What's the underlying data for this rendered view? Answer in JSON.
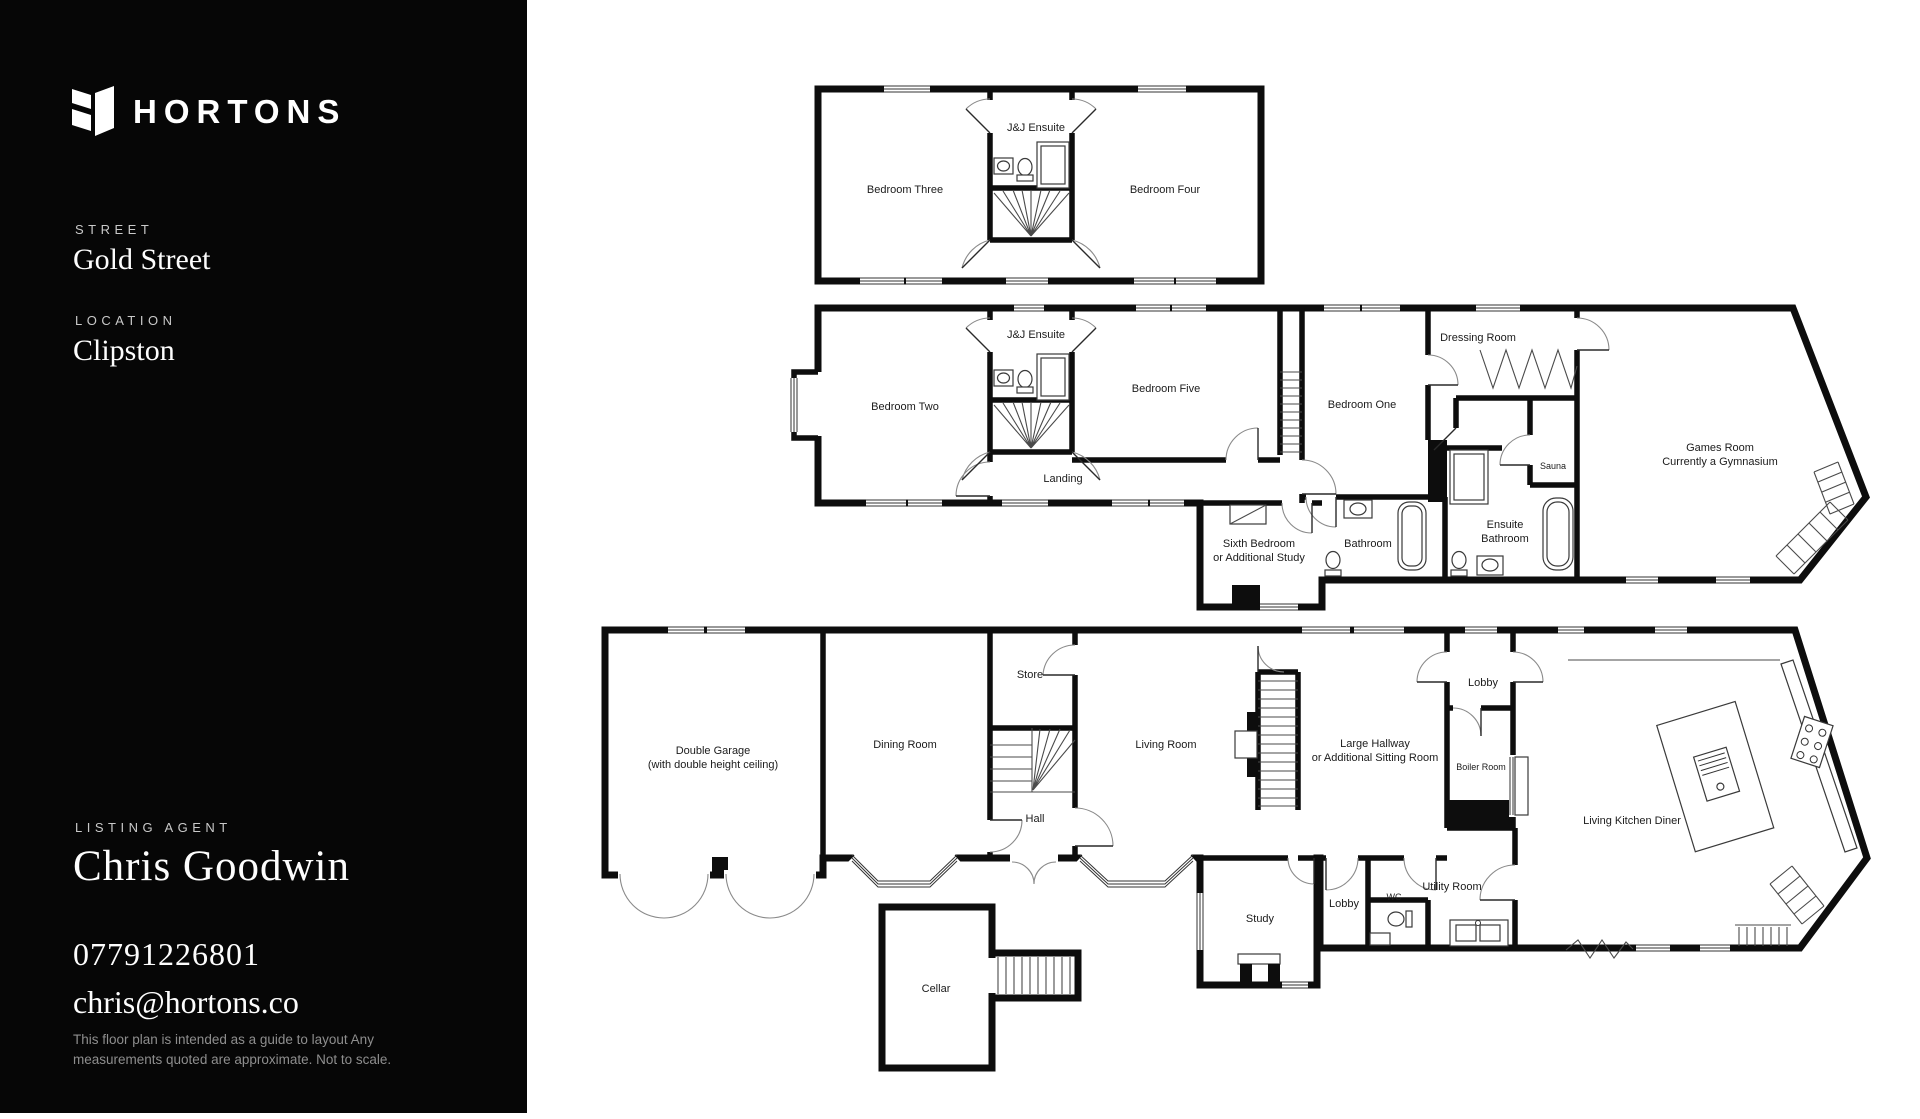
{
  "sidebar": {
    "brand": "HORTONS",
    "street_label": "STREET",
    "street_value": "Gold Street",
    "location_label": "LOCATION",
    "location_value": "Clipston",
    "agent_label": "LISTING AGENT",
    "agent_name": "Chris Goodwin",
    "phone": "07791226801",
    "email": "chris@hortons.co",
    "disclaimer": "This floor plan is intended  as a guide to layout Any measurements quoted are approximate. Not to scale.",
    "colors": {
      "background": "#060606",
      "text": "#ffffff",
      "muted": "#8e8e8e"
    }
  },
  "floorplan": {
    "second_floor": {
      "bedroom_three": "Bedroom Three",
      "jj_ensuite": "J&J Ensuite",
      "bedroom_four": "Bedroom Four"
    },
    "first_floor": {
      "bedroom_two": "Bedroom Two",
      "jj_ensuite": "J&J Ensuite",
      "bedroom_five": "Bedroom Five",
      "landing": "Landing",
      "bedroom_one": "Bedroom One",
      "dressing_room": "Dressing Room",
      "sauna": "Sauna",
      "games_room_line1": "Games Room",
      "games_room_line2": "Currently a Gymnasium",
      "sixth_bedroom_line1": "Sixth Bedroom",
      "sixth_bedroom_line2": "or Additional Study",
      "bathroom": "Bathroom",
      "ensuite_bathroom_line1": "Ensuite",
      "ensuite_bathroom_line2": "Bathroom"
    },
    "ground_floor": {
      "double_garage_line1": "Double Garage",
      "double_garage_line2": "(with double height ceiling)",
      "dining_room": "Dining Room",
      "store": "Store",
      "hall": "Hall",
      "living_room": "Living Room",
      "large_hallway_line1": "Large Hallway",
      "large_hallway_line2": "or Additional Sitting Room",
      "lobby_upper": "Lobby",
      "boiler_room": "Boiler Room",
      "living_kitchen_diner": "Living Kitchen Diner",
      "study": "Study",
      "lobby_lower": "Lobby",
      "wc": "WC",
      "utility_room": "Utility Room",
      "cellar": "Cellar"
    }
  }
}
